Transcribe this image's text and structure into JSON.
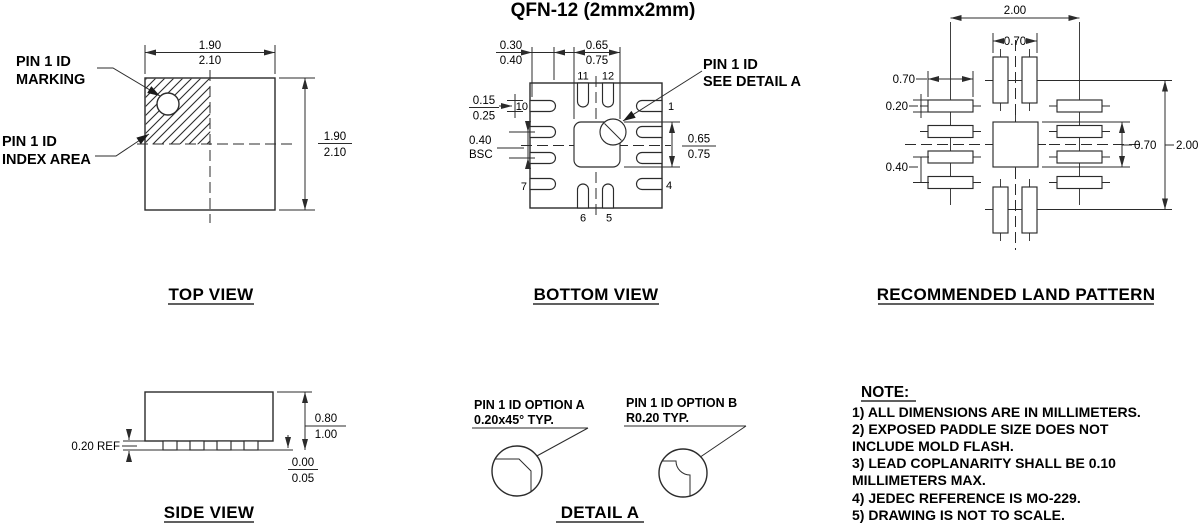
{
  "title": "QFN-12 (2mmx2mm)",
  "colors": {
    "line": "#2b2b2b",
    "text": "#000000",
    "background": "#ffffff"
  },
  "top_view": {
    "caption": "TOP VIEW",
    "marking_line1": "PIN 1 ID",
    "marking_line2": "MARKING",
    "index_line1": "PIN 1 ID",
    "index_line2": "INDEX AREA",
    "width_nom": "1.90",
    "width_max": "2.10",
    "height_nom": "1.90",
    "height_max": "2.10"
  },
  "bottom_view": {
    "caption": "BOTTOM VIEW",
    "lead_length_min": "0.30",
    "lead_length_max": "0.40",
    "paddle_width_min": "0.65",
    "paddle_width_max": "0.75",
    "lead_width_min": "0.15",
    "lead_width_max": "0.25",
    "pitch": "0.40",
    "pitch_qualifier": "BSC",
    "paddle_height_min": "0.65",
    "paddle_height_max": "0.75",
    "pin1_line1": "PIN 1 ID",
    "pin1_line2": "SEE DETAIL A",
    "pins": {
      "p1": "1",
      "p4": "4",
      "p5": "5",
      "p6": "6",
      "p7": "7",
      "p10": "10",
      "p11": "11",
      "p12": "12"
    }
  },
  "land_pattern": {
    "caption": "RECOMMENDED LAND PATTERN",
    "span_horizontal": "2.00",
    "top_pads_span": "0.70",
    "pad_length": "0.70",
    "pad_width": "0.20",
    "pad_pitch": "0.40",
    "center_pad_size": "0.70",
    "span_vertical": "2.00"
  },
  "side_view": {
    "caption": "SIDE VIEW",
    "lead_thickness": "0.20 REF",
    "height_min": "0.80",
    "height_max": "1.00",
    "standoff_min": "0.00",
    "standoff_max": "0.05"
  },
  "detail_a": {
    "caption": "DETAIL A",
    "option_a_line1": "PIN 1 ID OPTION A",
    "option_a_line2": "0.20x45° TYP.",
    "option_b_line1": "PIN 1 ID OPTION B",
    "option_b_line2": "R0.20 TYP."
  },
  "notes": {
    "heading": "NOTE:",
    "lines": [
      "1) ALL DIMENSIONS ARE IN MILLIMETERS.",
      "2) EXPOSED PADDLE SIZE DOES NOT",
      "INCLUDE MOLD FLASH.",
      "3) LEAD COPLANARITY SHALL BE 0.10",
      "MILLIMETERS MAX.",
      "4) JEDEC REFERENCE IS MO-229.",
      "5) DRAWING IS NOT TO SCALE."
    ]
  }
}
